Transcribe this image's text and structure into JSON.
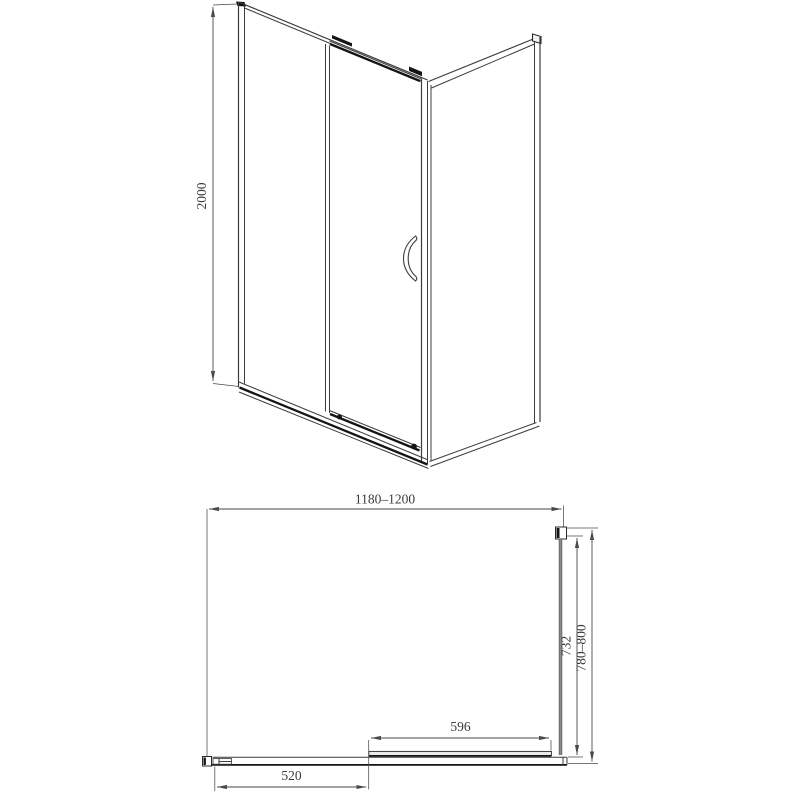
{
  "drawing": {
    "front": {
      "height_label": "2000"
    },
    "plan": {
      "width_label": "1180–1200",
      "inner_depth_label": "732",
      "outer_depth_label": "780–800",
      "door_width_label": "596",
      "left_section_label": "520"
    },
    "colors": {
      "background": "#ffffff",
      "line": "#3c3c3c",
      "dark": "#141414",
      "dim_line": "#4a4a4a",
      "glass_gray": "#8a8a8a"
    }
  }
}
